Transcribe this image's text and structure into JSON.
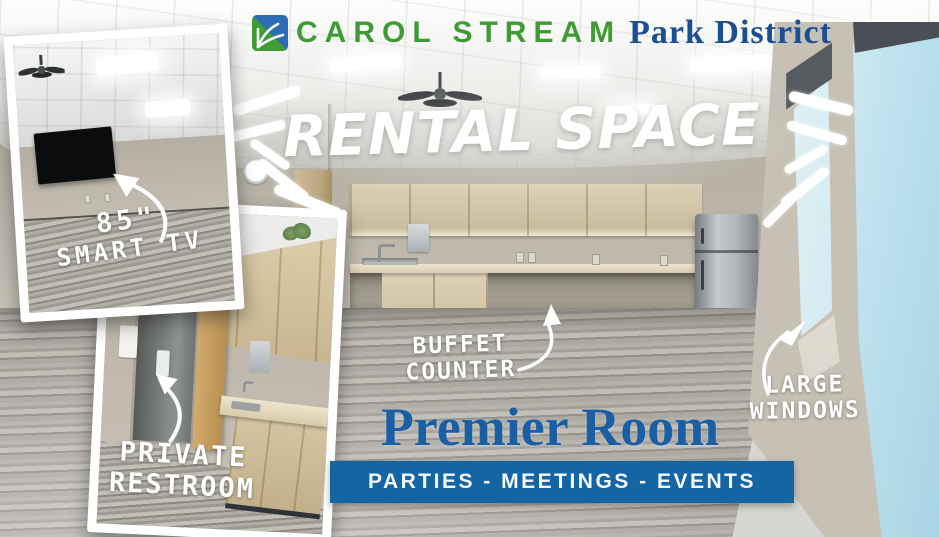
{
  "header": {
    "brand_primary": "CAROL STREAM",
    "brand_secondary": "Park District",
    "logo": "park-district-logo"
  },
  "hero": {
    "title": "RENTAL SPACE"
  },
  "callouts": {
    "tv": {
      "line1": "85\"",
      "line2": "SMART TV"
    },
    "restroom": {
      "line1": "PRIVATE",
      "line2": "RESTROOM"
    },
    "buffet": {
      "line1": "BUFFET",
      "line2": "COUNTER"
    },
    "windows": {
      "line1": "LARGE",
      "line2": "WINDOWS"
    }
  },
  "room": {
    "name": "Premier Room",
    "banner": "PARTIES - MEETINGS - EVENTS"
  },
  "colors": {
    "brand_green": "#3F9C35",
    "brand_blue": "#1B4F93",
    "banner_blue": "#1565A3",
    "room_title_blue": "#1A5FA3"
  }
}
